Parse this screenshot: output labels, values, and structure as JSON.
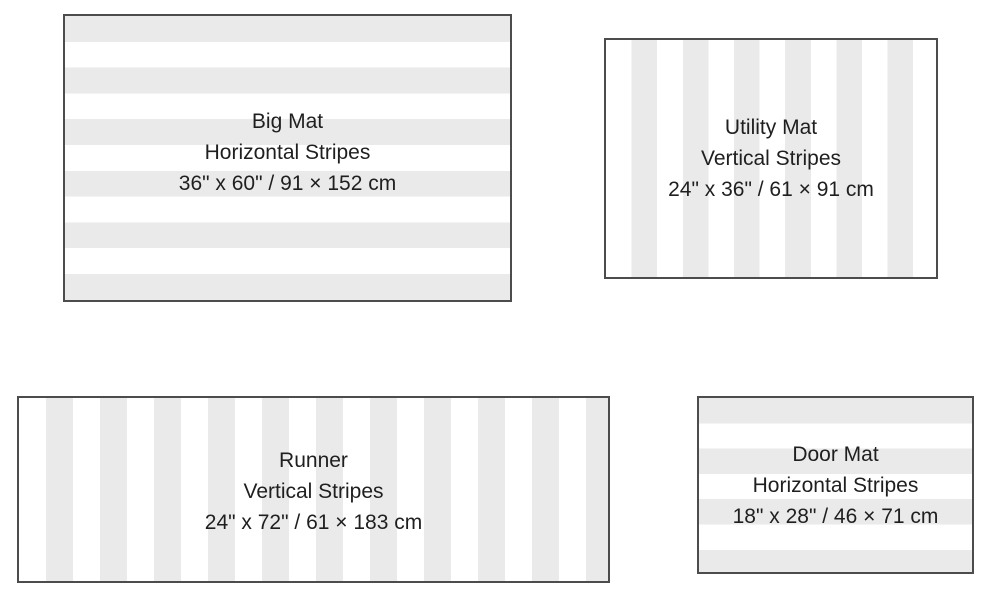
{
  "page": {
    "background": "#FFFFFF",
    "description_of_content": "Mat size guide diagram with four striped mat outlines"
  },
  "colors": {
    "stripe_gray": "#EAEAEA",
    "mat_white": "#FFFFFF",
    "border": "#4C4C4C",
    "text": "#1F1F1F"
  },
  "mats": [
    {
      "name": "Big Mat",
      "pattern": "Horizontal Stripes",
      "size": "36\" x 60\" / 91 × 152 cm",
      "stripe_direction": "horizontal"
    },
    {
      "name": "Utility Mat",
      "pattern": "Vertical Stripes",
      "size": "24\" x 36\" / 61 × 91 cm",
      "stripe_direction": "vertical"
    },
    {
      "name": "Runner",
      "pattern": "Vertical Stripes",
      "size": "24\" x 72\" / 61 × 183 cm",
      "stripe_direction": "vertical"
    },
    {
      "name": "Door Mat",
      "pattern": "Horizontal Stripes",
      "size": "18\" x 28\" / 46 × 71 cm",
      "stripe_direction": "horizontal"
    }
  ]
}
